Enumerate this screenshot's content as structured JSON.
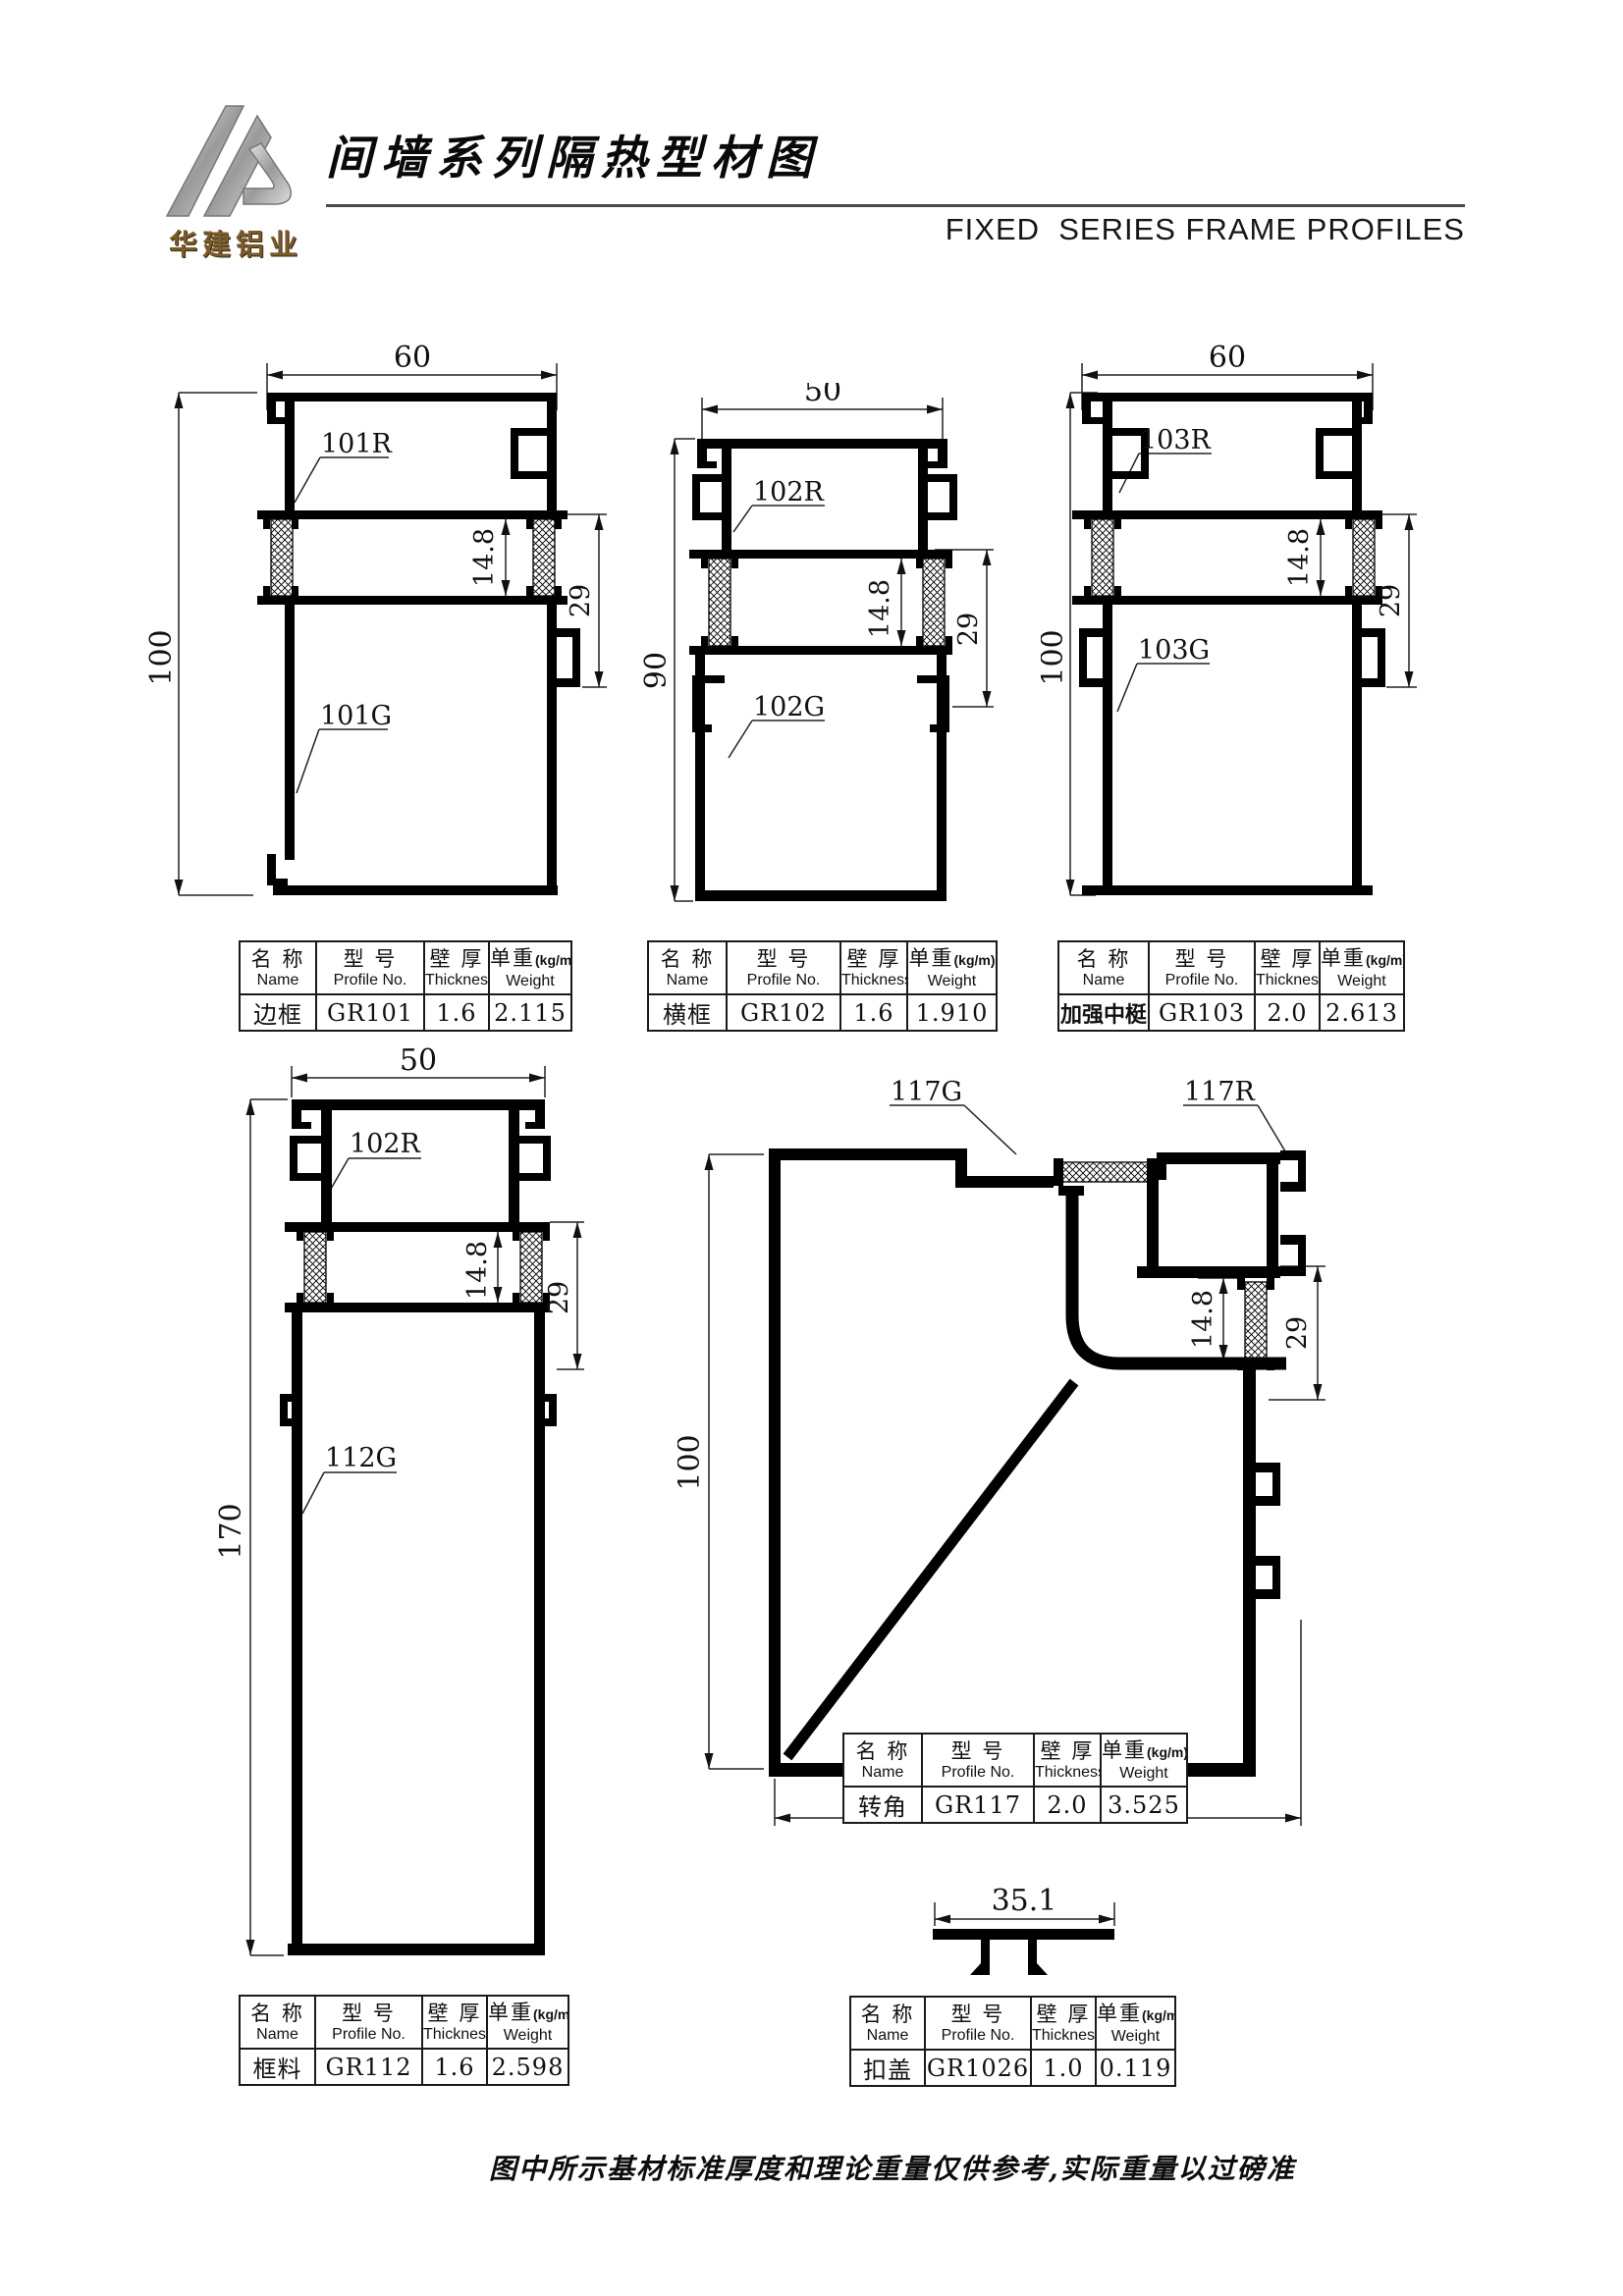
{
  "header": {
    "logo_text": "华建铝业",
    "title": "间墙系列隔热型材图",
    "subtitle": "FIXED  SERIES FRAME PROFILES"
  },
  "table_header": {
    "name_cn": "名 称",
    "name_en": "Name",
    "profile_cn": "型 号",
    "profile_en": "Profile No.",
    "thickness_cn": "壁 厚",
    "thickness_en": "Thickness",
    "weight_cn": "单重",
    "weight_unit": "(kg/m)",
    "weight_en": "Weight"
  },
  "tables": [
    {
      "name": "边框",
      "profile_no": "GR101",
      "thickness": "1.6",
      "weight": "2.115"
    },
    {
      "name": "横框",
      "profile_no": "GR102",
      "thickness": "1.6",
      "weight": "1.910"
    },
    {
      "name": "加强中梃",
      "profile_no": "GR103",
      "thickness": "2.0",
      "weight": "2.613"
    },
    {
      "name": "框料",
      "profile_no": "GR112",
      "thickness": "1.6",
      "weight": "2.598"
    },
    {
      "name": "转角",
      "profile_no": "GR117",
      "thickness": "2.0",
      "weight": "3.525"
    },
    {
      "name": "扣盖",
      "profile_no": "GR1026",
      "thickness": "1.0",
      "weight": "0.119"
    }
  ],
  "drawings": {
    "p101": {
      "dim_w": "60",
      "dim_h": "100",
      "dim_a": "14.8",
      "dim_b": "29",
      "label_r": "101R",
      "label_g": "101G"
    },
    "p102": {
      "dim_w": "50",
      "dim_h": "90",
      "dim_a": "14.8",
      "dim_b": "29",
      "label_r": "102R",
      "label_g": "102G"
    },
    "p103": {
      "dim_w": "60",
      "dim_h": "100",
      "dim_a": "14.8",
      "dim_b": "29",
      "label_r": "103R",
      "label_g": "103G"
    },
    "p112": {
      "dim_w": "50",
      "dim_h": "170",
      "dim_a": "14.8",
      "dim_b": "29",
      "label_r": "102R",
      "label_g": "112G"
    },
    "p117": {
      "dim_h": "100",
      "dim_w_bottom": "100",
      "dim_a": "14.8",
      "dim_b": "29",
      "label_g": "117G",
      "label_r": "117R"
    },
    "p1026": {
      "dim_w": "35.1"
    }
  },
  "footer": {
    "note": "图中所示基材标准厚度和理论重量仅供参考,实际重量以过磅准"
  }
}
